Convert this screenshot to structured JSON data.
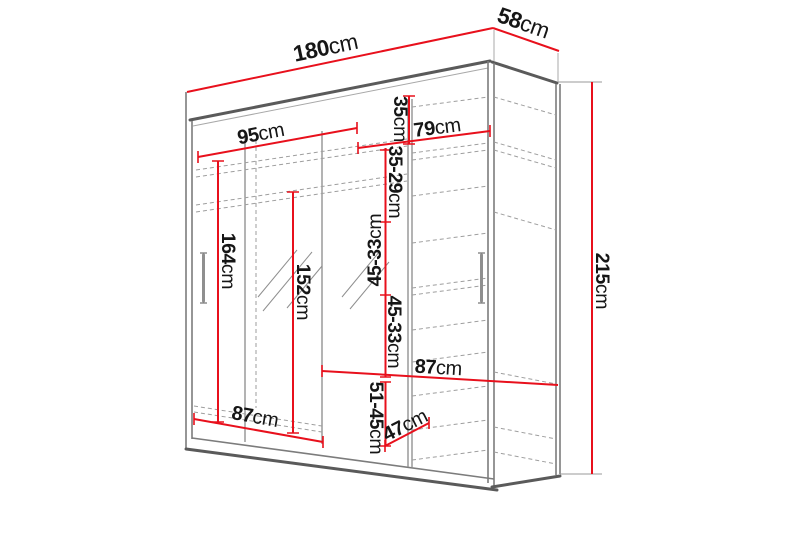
{
  "diagram_title": "Wardrobe dimension diagram",
  "colors": {
    "dimension_red": "#e8101c",
    "outline_gray": "#5a5a5a",
    "shelf_dash_gray": "#9e9e9e",
    "label_text": "#161616"
  },
  "dimensions": {
    "total_width": {
      "value": "180",
      "unit": "cm"
    },
    "total_depth": {
      "value": "58",
      "unit": "cm"
    },
    "total_height": {
      "value": "215",
      "unit": "cm"
    },
    "left_top_width": {
      "value": "95",
      "unit": "cm"
    },
    "right_top_width": {
      "value": "79",
      "unit": "cm"
    },
    "top_shelf_gap": {
      "value": "35",
      "unit": "cm"
    },
    "shelf_gap_upper": {
      "value": "35-29",
      "unit": "cm"
    },
    "shelf_gap_mid_a": {
      "value": "45-33",
      "unit": "cm"
    },
    "shelf_gap_mid_b": {
      "value": "45-33",
      "unit": "cm"
    },
    "left_door_height": {
      "value": "164",
      "unit": "cm"
    },
    "mirror_height": {
      "value": "152",
      "unit": "cm"
    },
    "left_bottom_width": {
      "value": "87",
      "unit": "cm"
    },
    "right_shelf_width": {
      "value": "87",
      "unit": "cm"
    },
    "bottom_shelf_gap": {
      "value": "51-45",
      "unit": "cm"
    },
    "bottom_depth": {
      "value": "47",
      "unit": "cm"
    }
  }
}
